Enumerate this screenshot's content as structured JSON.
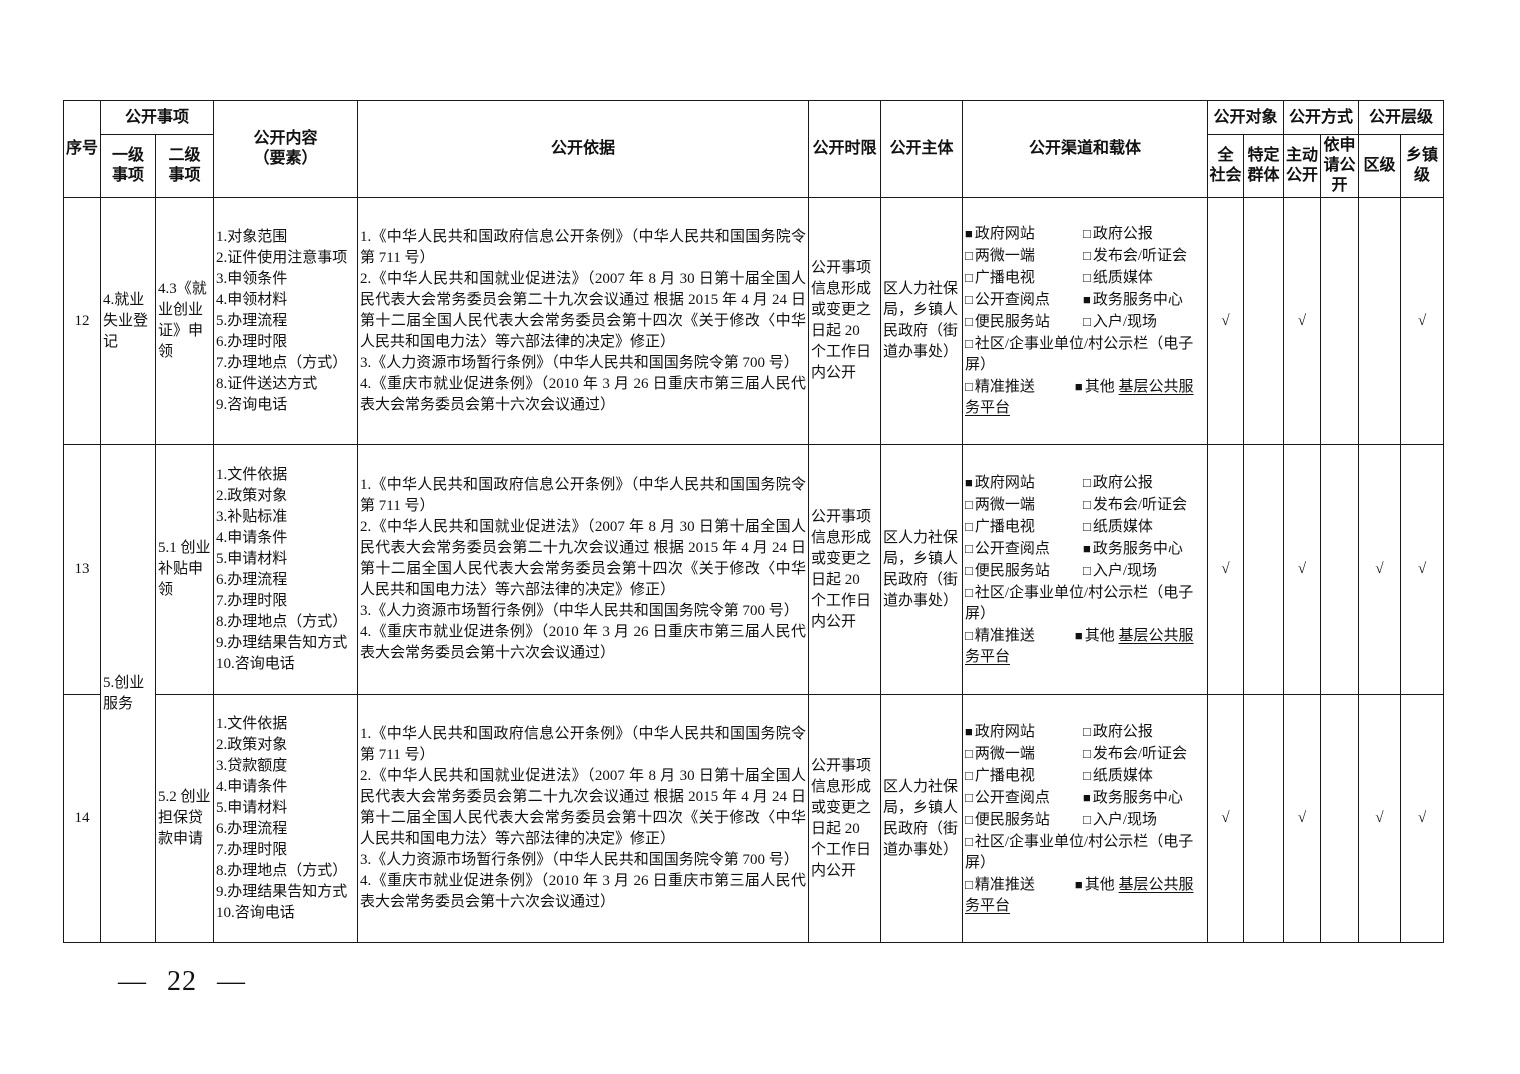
{
  "page": {
    "footer_display": "— 22 —"
  },
  "header": {
    "xuhao": "序号",
    "gongkai_shixiang": "公开事项",
    "yiji": "一级\n事项",
    "erji": "二级\n事项",
    "neirong": "公开内容\n（要素）",
    "yiju": "公开依据",
    "shixian": "公开时限",
    "zhuti": "公开主体",
    "qudao": "公开渠道和载体",
    "duixiang": "公开对象",
    "quanshehui": "全\n社会",
    "teding": "特定\n群体",
    "fangshi": "公开方式",
    "zhudong": "主动\n公开",
    "yishenqing": "依申\n请公\n开",
    "cengji": "公开层级",
    "quji": "区级",
    "xiangzhen": "乡镇\n级"
  },
  "rows": [
    {
      "seq": "12",
      "level1": "4.就业失业登记",
      "level2": "4.3《就业创业证》申领",
      "content": "1.对象范围\n2.证件使用注意事项\n3.申领条件\n4.申领材料\n5.办理流程\n6.办理时限\n7.办理地点（方式）\n8.证件送达方式\n9.咨询电话",
      "basis": [
        "1.《中华人民共和国政府信息公开条例》（中华人民共和国国务院令第 711 号）",
        "2.《中华人民共和国就业促进法》（2007 年 8 月 30 日第十届全国人民代表大会常务委员会第二十九次会议通过 根据 2015 年 4 月 24 日第十二届全国人民代表大会常务委员会第十四次《关于修改〈中华人民共和国电力法〉等六部法律的决定》修正）",
        "3.《人力资源市场暂行条例》（中华人民共和国国务院令第 700 号）",
        "4.《重庆市就业促进条例》（2010 年 3 月 26 日重庆市第三届人民代表大会常务委员会第十六次会议通过）"
      ],
      "time_limit": "公开事项信息形成或变更之日起 20 个工作日内公开",
      "subject": "区人力社保局，乡镇人民政府（街道办事处）",
      "channels": {
        "items": [
          {
            "label": "政府网站",
            "checked": true
          },
          {
            "label": "政府公报",
            "checked": false
          },
          {
            "label": "两微一端",
            "checked": false
          },
          {
            "label": "发布会/听证会",
            "checked": false
          },
          {
            "label": "广播电视",
            "checked": false
          },
          {
            "label": "纸质媒体",
            "checked": false
          },
          {
            "label": "公开查阅点",
            "checked": false
          },
          {
            "label": "政务服务中心",
            "checked": true
          },
          {
            "label": "便民服务站",
            "checked": false
          },
          {
            "label": "入户/现场",
            "checked": false
          }
        ],
        "wide_item": {
          "label": "社区/企事业单位/村公示栏（电子屏）",
          "checked": false
        },
        "tail_left": {
          "label": "精准推送",
          "checked": false
        },
        "other_item": {
          "label": "其他",
          "checked": true,
          "fill_text": "基层公共服务平台"
        }
      },
      "checks": [
        "√",
        "",
        "√",
        "",
        "",
        "√"
      ]
    },
    {
      "seq": "13",
      "level1": "5.创业服务",
      "level2": "5.1 创业补贴申领",
      "content": "1.文件依据\n2.政策对象\n3.补贴标准\n4.申请条件\n5.申请材料\n6.办理流程\n7.办理时限\n8.办理地点（方式）\n9.办理结果告知方式\n10.咨询电话",
      "basis": [
        "1.《中华人民共和国政府信息公开条例》（中华人民共和国国务院令第 711 号）",
        "2.《中华人民共和国就业促进法》（2007 年 8 月 30 日第十届全国人民代表大会常务委员会第二十九次会议通过 根据 2015 年 4 月 24 日第十二届全国人民代表大会常务委员会第十四次《关于修改〈中华人民共和国电力法〉等六部法律的决定》修正）",
        "3.《人力资源市场暂行条例》（中华人民共和国国务院令第 700 号）",
        "4.《重庆市就业促进条例》（2010 年 3 月 26 日重庆市第三届人民代表大会常务委员会第十六次会议通过）"
      ],
      "time_limit": "公开事项信息形成或变更之日起 20 个工作日内公开",
      "subject": "区人力社保局，乡镇人民政府（街道办事处）",
      "channels": {
        "items": [
          {
            "label": "政府网站",
            "checked": true
          },
          {
            "label": "政府公报",
            "checked": false
          },
          {
            "label": "两微一端",
            "checked": false
          },
          {
            "label": "发布会/听证会",
            "checked": false
          },
          {
            "label": "广播电视",
            "checked": false
          },
          {
            "label": "纸质媒体",
            "checked": false
          },
          {
            "label": "公开查阅点",
            "checked": false
          },
          {
            "label": "政务服务中心",
            "checked": true
          },
          {
            "label": "便民服务站",
            "checked": false
          },
          {
            "label": "入户/现场",
            "checked": false
          }
        ],
        "wide_item": {
          "label": "社区/企事业单位/村公示栏（电子屏）",
          "checked": false
        },
        "tail_left": {
          "label": "精准推送",
          "checked": false
        },
        "other_item": {
          "label": "其他",
          "checked": true,
          "fill_text": "基层公共服务平台"
        }
      },
      "checks": [
        "√",
        "",
        "√",
        "",
        "√",
        "√"
      ]
    },
    {
      "seq": "14",
      "level1": "",
      "level2": "5.2 创业担保贷款申请",
      "content": "1.文件依据\n2.政策对象\n3.贷款额度\n4.申请条件\n5.申请材料\n6.办理流程\n7.办理时限\n8.办理地点（方式）\n9.办理结果告知方式\n10.咨询电话",
      "basis": [
        "1.《中华人民共和国政府信息公开条例》（中华人民共和国国务院令第 711 号）",
        "2.《中华人民共和国就业促进法》（2007 年 8 月 30 日第十届全国人民代表大会常务委员会第二十九次会议通过 根据 2015 年 4 月 24 日第十二届全国人民代表大会常务委员会第十四次《关于修改〈中华人民共和国电力法〉等六部法律的决定》修正）",
        "3.《人力资源市场暂行条例》（中华人民共和国国务院令第 700 号）",
        "4.《重庆市就业促进条例》（2010 年 3 月 26 日重庆市第三届人民代表大会常务委员会第十六次会议通过）"
      ],
      "time_limit": "公开事项信息形成或变更之日起 20 个工作日内公开",
      "subject": "区人力社保局，乡镇人民政府（街道办事处）",
      "channels": {
        "items": [
          {
            "label": "政府网站",
            "checked": true
          },
          {
            "label": "政府公报",
            "checked": false
          },
          {
            "label": "两微一端",
            "checked": false
          },
          {
            "label": "发布会/听证会",
            "checked": false
          },
          {
            "label": "广播电视",
            "checked": false
          },
          {
            "label": "纸质媒体",
            "checked": false
          },
          {
            "label": "公开查阅点",
            "checked": false
          },
          {
            "label": "政务服务中心",
            "checked": true
          },
          {
            "label": "便民服务站",
            "checked": false
          },
          {
            "label": "入户/现场",
            "checked": false
          }
        ],
        "wide_item": {
          "label": "社区/企事业单位/村公示栏（电子屏）",
          "checked": false
        },
        "tail_left": {
          "label": "精准推送",
          "checked": false
        },
        "other_item": {
          "label": "其他",
          "checked": true,
          "fill_text": "基层公共服务平台"
        }
      },
      "checks": [
        "√",
        "",
        "√",
        "",
        "√",
        "√"
      ]
    }
  ]
}
